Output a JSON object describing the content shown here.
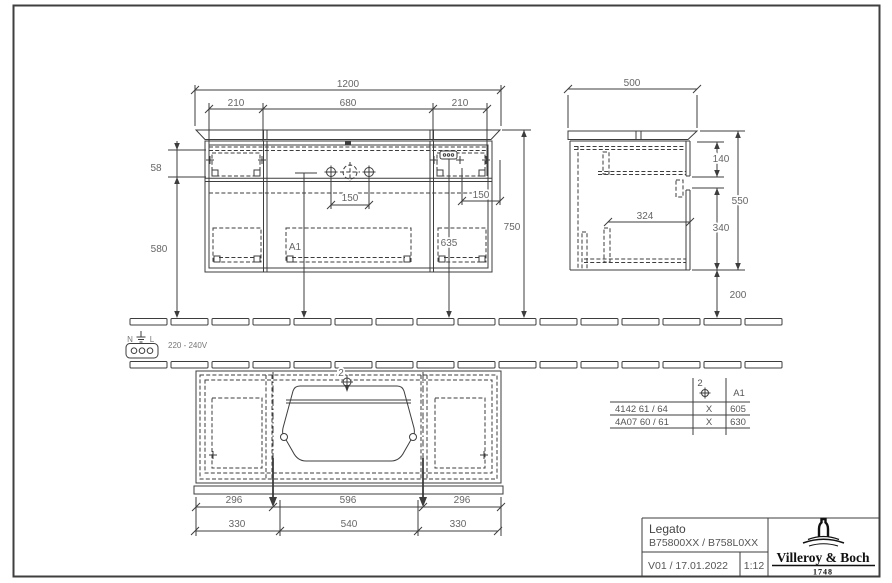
{
  "front_view": {
    "dim_total": "1200",
    "segments": [
      "210",
      "680",
      "210"
    ],
    "hinge_offset": "58",
    "lower_height": "580",
    "overall_height": "750",
    "tap_spans": [
      "150",
      "150"
    ],
    "socket_height": "635",
    "drain_label": "A1"
  },
  "side_view": {
    "depth": "500",
    "top_drawer": "140",
    "height": "550",
    "bottom_drawer": "340",
    "inner_depth": "324",
    "clearance": "200"
  },
  "electrical": {
    "neutral": "N",
    "line": "L",
    "voltage": "220 - 240V"
  },
  "plan_view": {
    "callout": "2",
    "basin_dims": [
      "296",
      "596",
      "296"
    ],
    "mount_dims": [
      "330",
      "540",
      "330"
    ]
  },
  "variant_table": {
    "header_tap": "2",
    "header_a1": "A1",
    "rows": [
      {
        "code": "4142 61 / 64",
        "tap": "X",
        "a1": "605"
      },
      {
        "code": "4A07 60 / 61",
        "tap": "X",
        "a1": "630"
      }
    ]
  },
  "title_block": {
    "product": "Legato",
    "codes": "B75800XX / B758L0XX",
    "revision": "V01 / 17.01.2022",
    "scale": "1:12",
    "brand": "Villeroy & Boch",
    "year": "1748"
  }
}
